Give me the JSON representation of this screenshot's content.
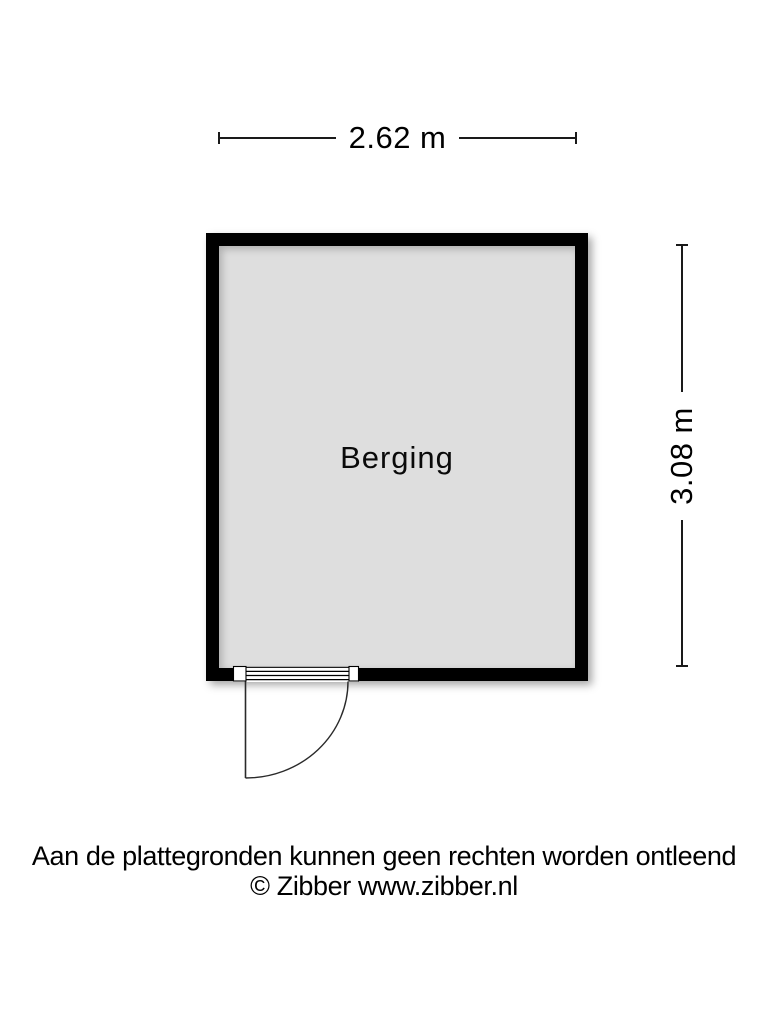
{
  "floorplan": {
    "type": "floor-plan",
    "rooms": [
      {
        "name": "Berging"
      }
    ],
    "dimensions": {
      "width_label": "2.62 m",
      "height_label": "3.08 m"
    },
    "features": [
      {
        "name": "door",
        "wall": "bottom",
        "swing": "outward quarter-circle, hinge left"
      }
    ]
  },
  "footer": {
    "disclaimer": "Aan de plattegronden kunnen geen rechten worden ontleend",
    "copyright": "© Zibber www.zibber.nl"
  },
  "colors": {
    "wall": "#000000",
    "room_fill": "#dedede",
    "background": "#ffffff",
    "line": "#1a1a1a"
  }
}
